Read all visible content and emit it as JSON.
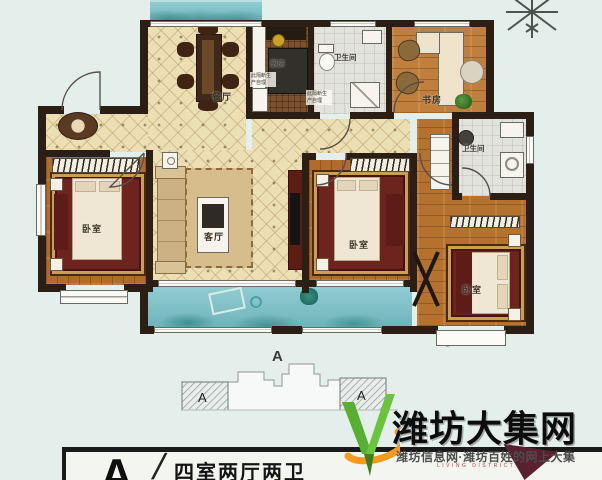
{
  "plan": {
    "rooms": {
      "dining": "餐厅",
      "kitchen": "厨房",
      "bath_top": "卫生间",
      "study": "书房",
      "bath_right": "卫生间",
      "bedroom_left": "卧室",
      "living": "客厅",
      "bedroom_middle": "卧室",
      "bedroom_right": "卧室"
    },
    "notes": {
      "kitchen_partition": "此隔断生产自理",
      "bath_partition": "此隔断生产自理"
    }
  },
  "section_key": {
    "marker": "A",
    "left_unit": "A",
    "right_unit": "A"
  },
  "legend": {
    "unit_letter": "A",
    "divider": "/",
    "title": "四室两厅两卫"
  },
  "watermark": {
    "brand": "潍坊大集网",
    "tagline": "潍坊信息网·潍坊百姓的网上大集",
    "subtext": "LIVING DISTRICT"
  },
  "colors": {
    "balcony_teal": "#7cc4ca",
    "wall_dark": "#2b1f15",
    "wood_floor": "#b06c2c",
    "tile_cream": "#ecdfb4",
    "rug_maroon": "#6e241e",
    "logo_green": "#57b02f",
    "logo_orange": "#f59a1c"
  }
}
